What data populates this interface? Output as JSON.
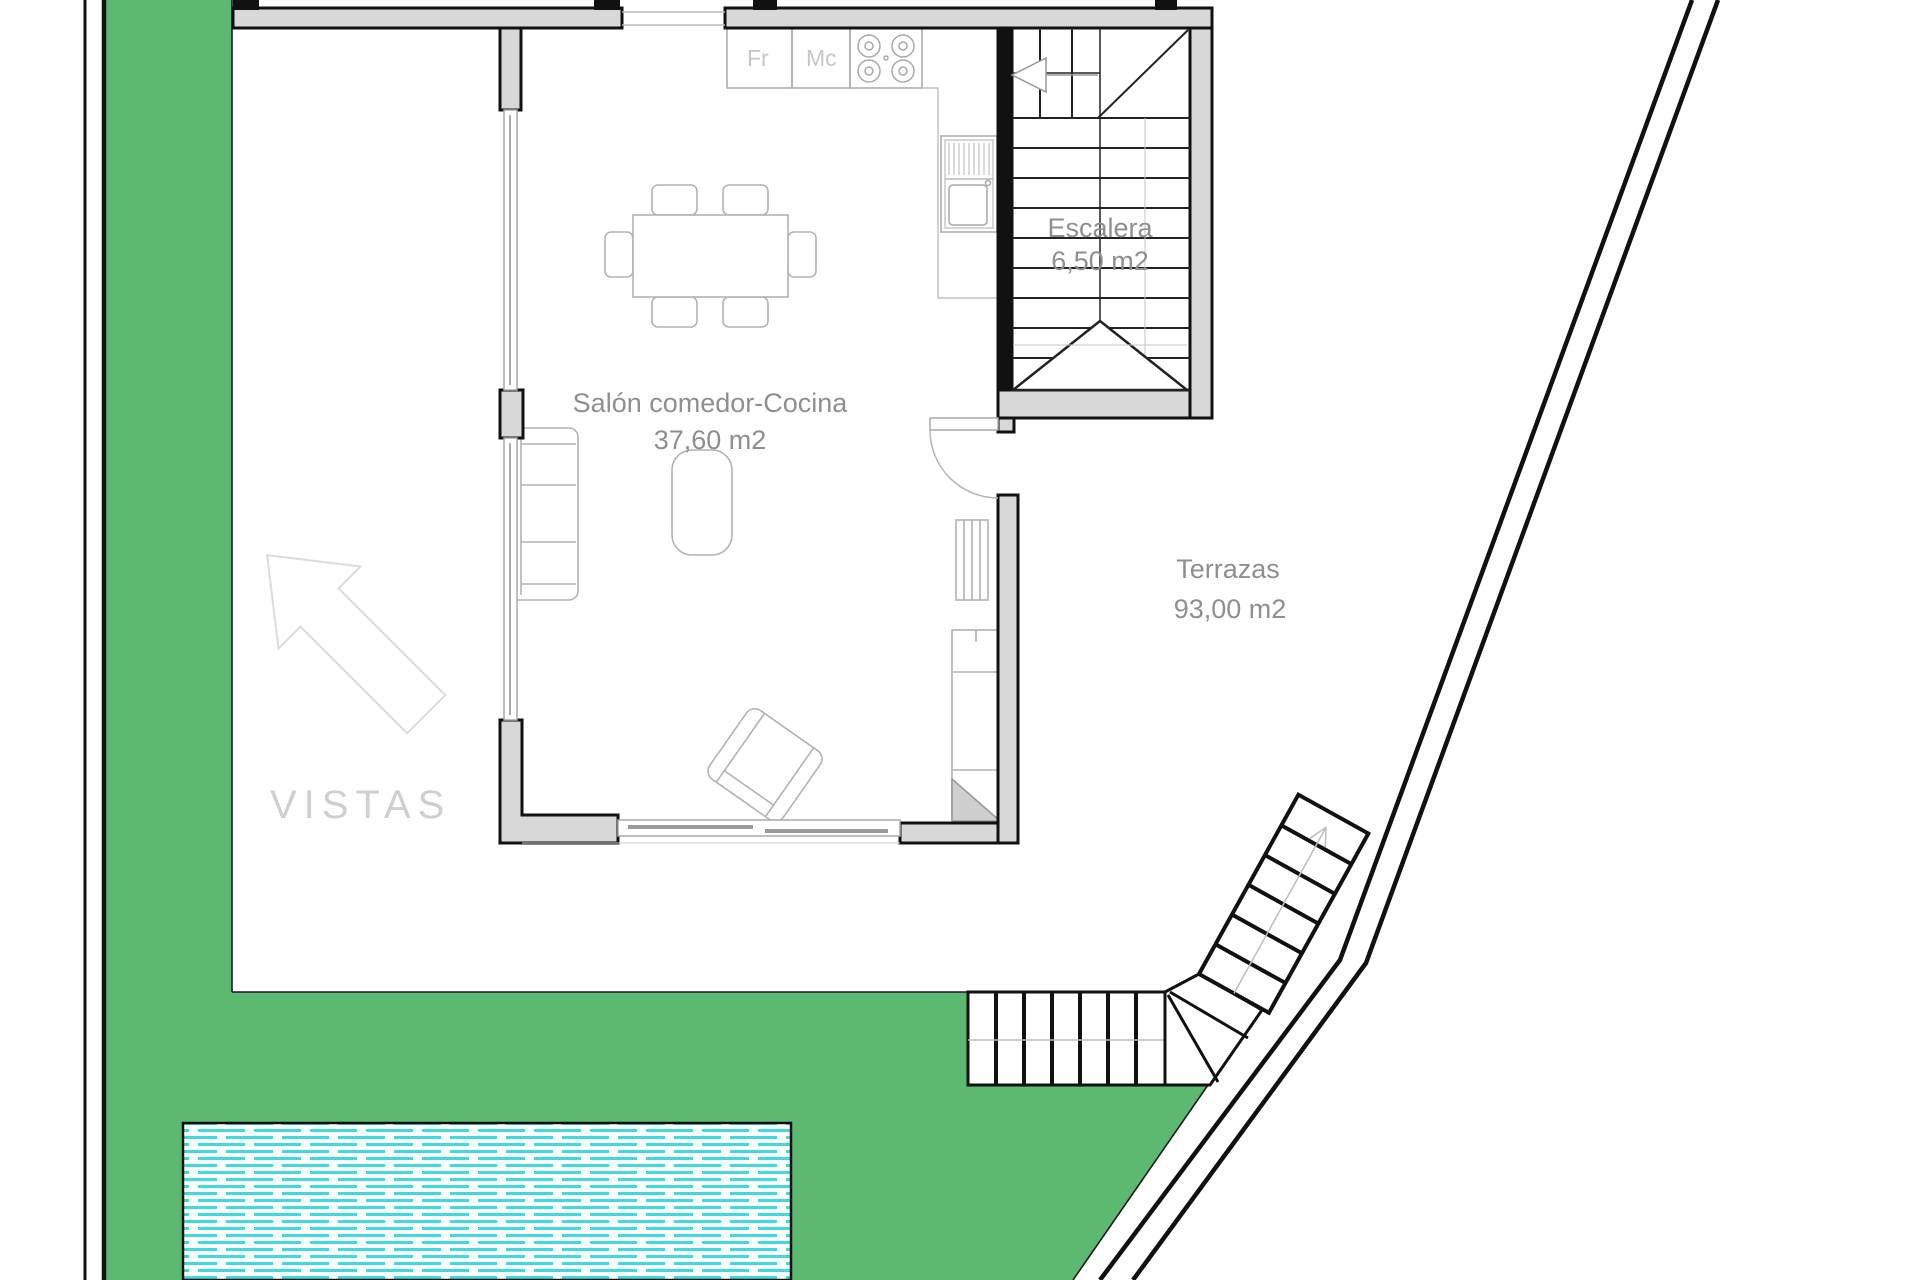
{
  "document": {
    "type": "architectural-floor-plan",
    "floor": "ground-floor"
  },
  "labels": {
    "salon": {
      "line1": "Salón comedor-Cocina",
      "line2": "37,60 m2"
    },
    "escalera": {
      "line1": "Escalera",
      "line2": "6,50 m2"
    },
    "terrazas": {
      "line1": "Terrazas",
      "line2": "93,00 m2"
    },
    "vistas": "VISTAS",
    "kitchen": {
      "fridge": "Fr",
      "microwave": "Mc"
    }
  },
  "colors": {
    "garden_green": "#5cb971",
    "pool_cyan": "#3fd9e0",
    "wall_fill": "#d8d8d8",
    "wall_line": "#111111",
    "label_gray": "#8f8f8f",
    "furniture_gray": "#b3b3b3"
  }
}
